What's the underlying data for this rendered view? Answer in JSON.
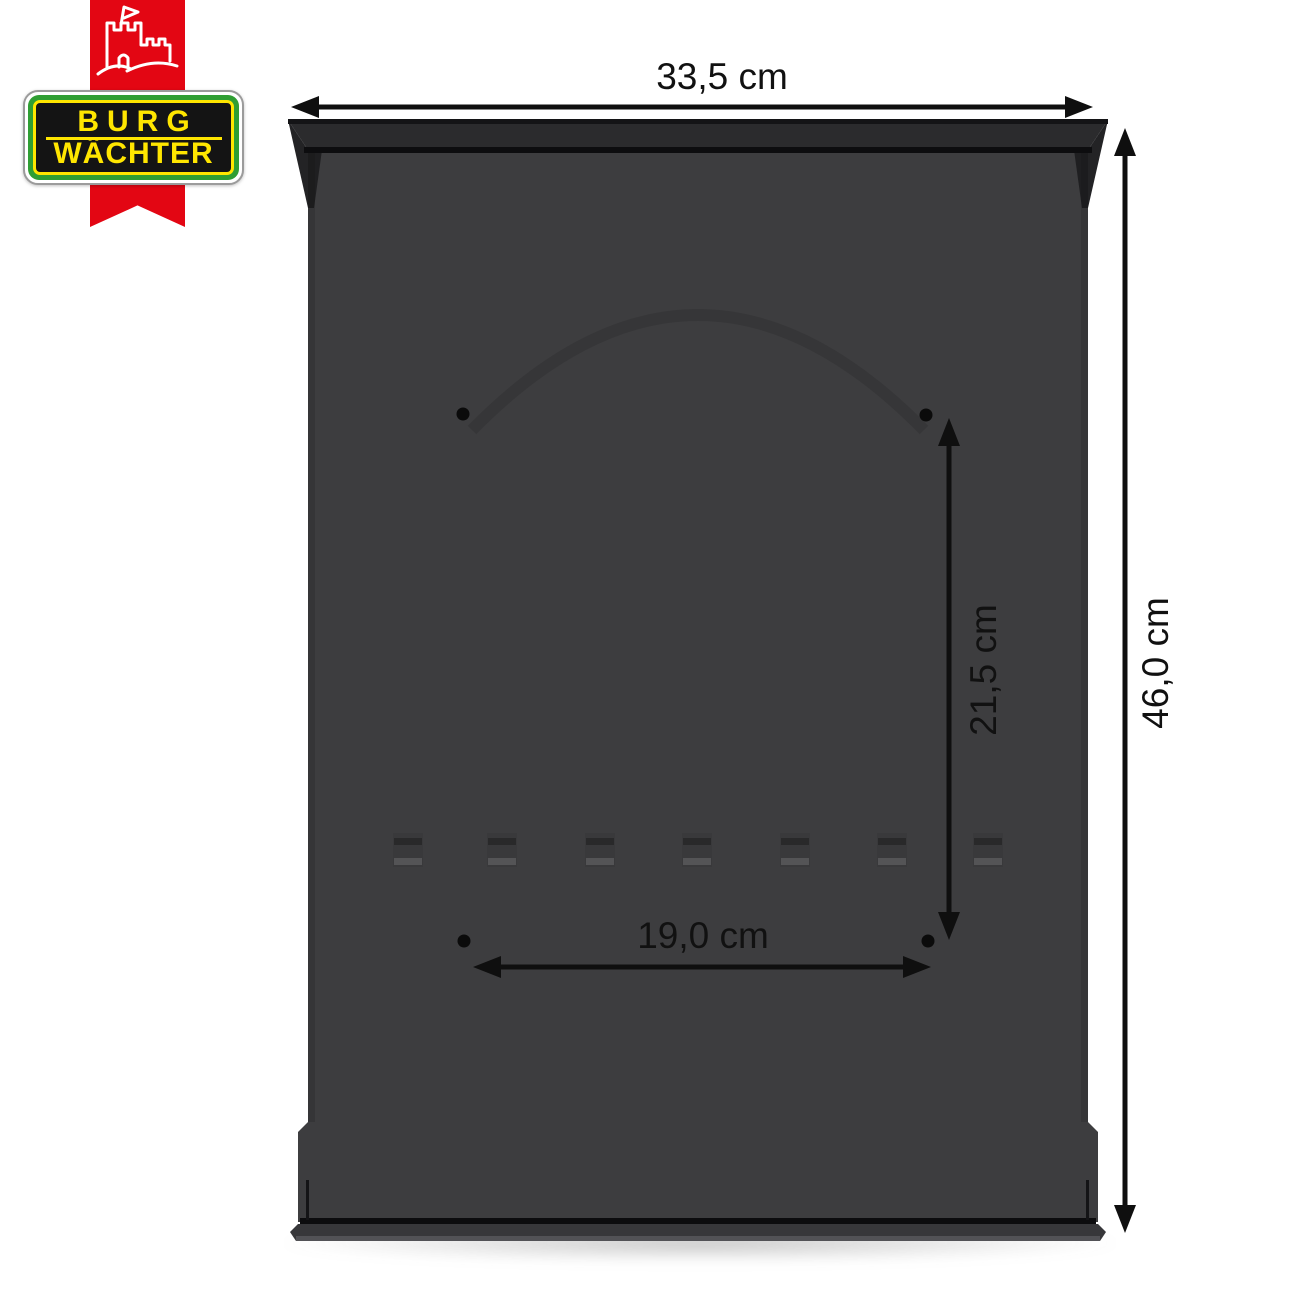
{
  "brand": {
    "line1": "BURG",
    "line2": "WÄCHTER",
    "colors": {
      "ribbon_red": "#e30613",
      "logo_green": "#2f9e33",
      "logo_yellow": "#ffe600",
      "logo_black": "#141414"
    }
  },
  "icons": {
    "castle": "castle-icon"
  },
  "dimensions": {
    "overall_width": {
      "label": "33,5 cm"
    },
    "overall_height": {
      "label": "46,0 cm"
    },
    "hole_spacing_vertical": {
      "label": "21,5 cm"
    },
    "hole_spacing_horizontal": {
      "label": "19,0 cm"
    }
  },
  "colors": {
    "background": "#ffffff",
    "panel_body": "#3d3d3f",
    "panel_lip": "#2b2b2d",
    "dimension_ink": "#111111"
  }
}
